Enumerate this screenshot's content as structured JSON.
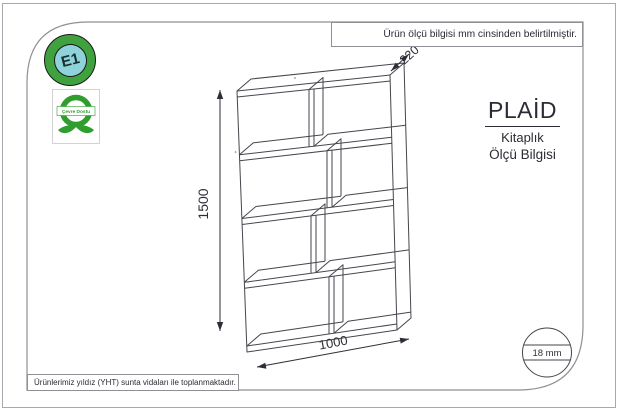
{
  "sheet": {
    "top_note": "Ürün ölçü bilgisi mm cinsinden belirtilmiştir.",
    "bottom_note": "Ürünlerimiz yıldız (YHT) sunta vidaları ile toplanmaktadır."
  },
  "badges": {
    "e1": "E1",
    "eco": "Çevre Dostu"
  },
  "product": {
    "name": "PLAİD",
    "category": "Kitaplık",
    "info_label": "Ölçü Bilgisi"
  },
  "dimensions": {
    "height_mm": "1500",
    "width_mm": "1000",
    "depth_mm": "220",
    "panel_thickness": "18 mm"
  },
  "colors": {
    "accent_green": "#3fa23f",
    "badge_blue": "#8fd2d9",
    "drawing_line": "#45454d",
    "frame_gray": "#8f8f96"
  }
}
